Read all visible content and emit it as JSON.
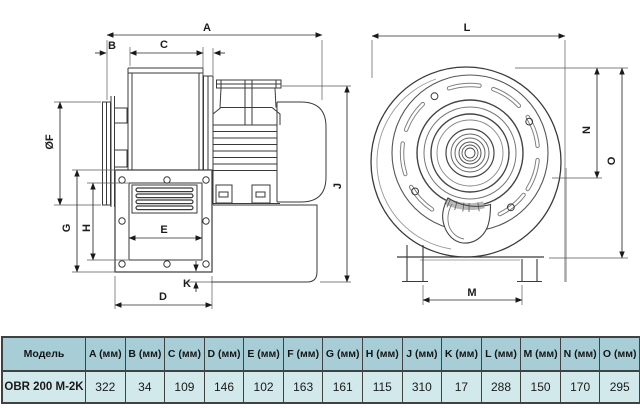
{
  "drawing": {
    "labels": {
      "A": "A",
      "B": "B",
      "C": "C",
      "D": "D",
      "E": "E",
      "F": "ØF",
      "G": "G",
      "H": "H",
      "J": "J",
      "K": "K",
      "L": "L",
      "M": "M",
      "N": "N",
      "O": "O"
    }
  },
  "table": {
    "headers": [
      "Модель",
      "A (мм)",
      "B (мм)",
      "C (мм)",
      "D (мм)",
      "E (мм)",
      "F (мм)",
      "G (мм)",
      "H (мм)",
      "J (мм)",
      "K (мм)",
      "L (мм)",
      "M (мм)",
      "N (мм)",
      "O (мм)"
    ],
    "rows": [
      [
        "OBR 200 M-2K",
        "322",
        "34",
        "109",
        "146",
        "102",
        "163",
        "161",
        "115",
        "310",
        "17",
        "288",
        "150",
        "170",
        "295"
      ]
    ]
  },
  "colors": {
    "table_header_bg": "#a7ced7",
    "table_row_bg": "#d2e9eb",
    "table_border": "#414141",
    "line_color": "#3a3a3a",
    "background": "#ffffff"
  }
}
